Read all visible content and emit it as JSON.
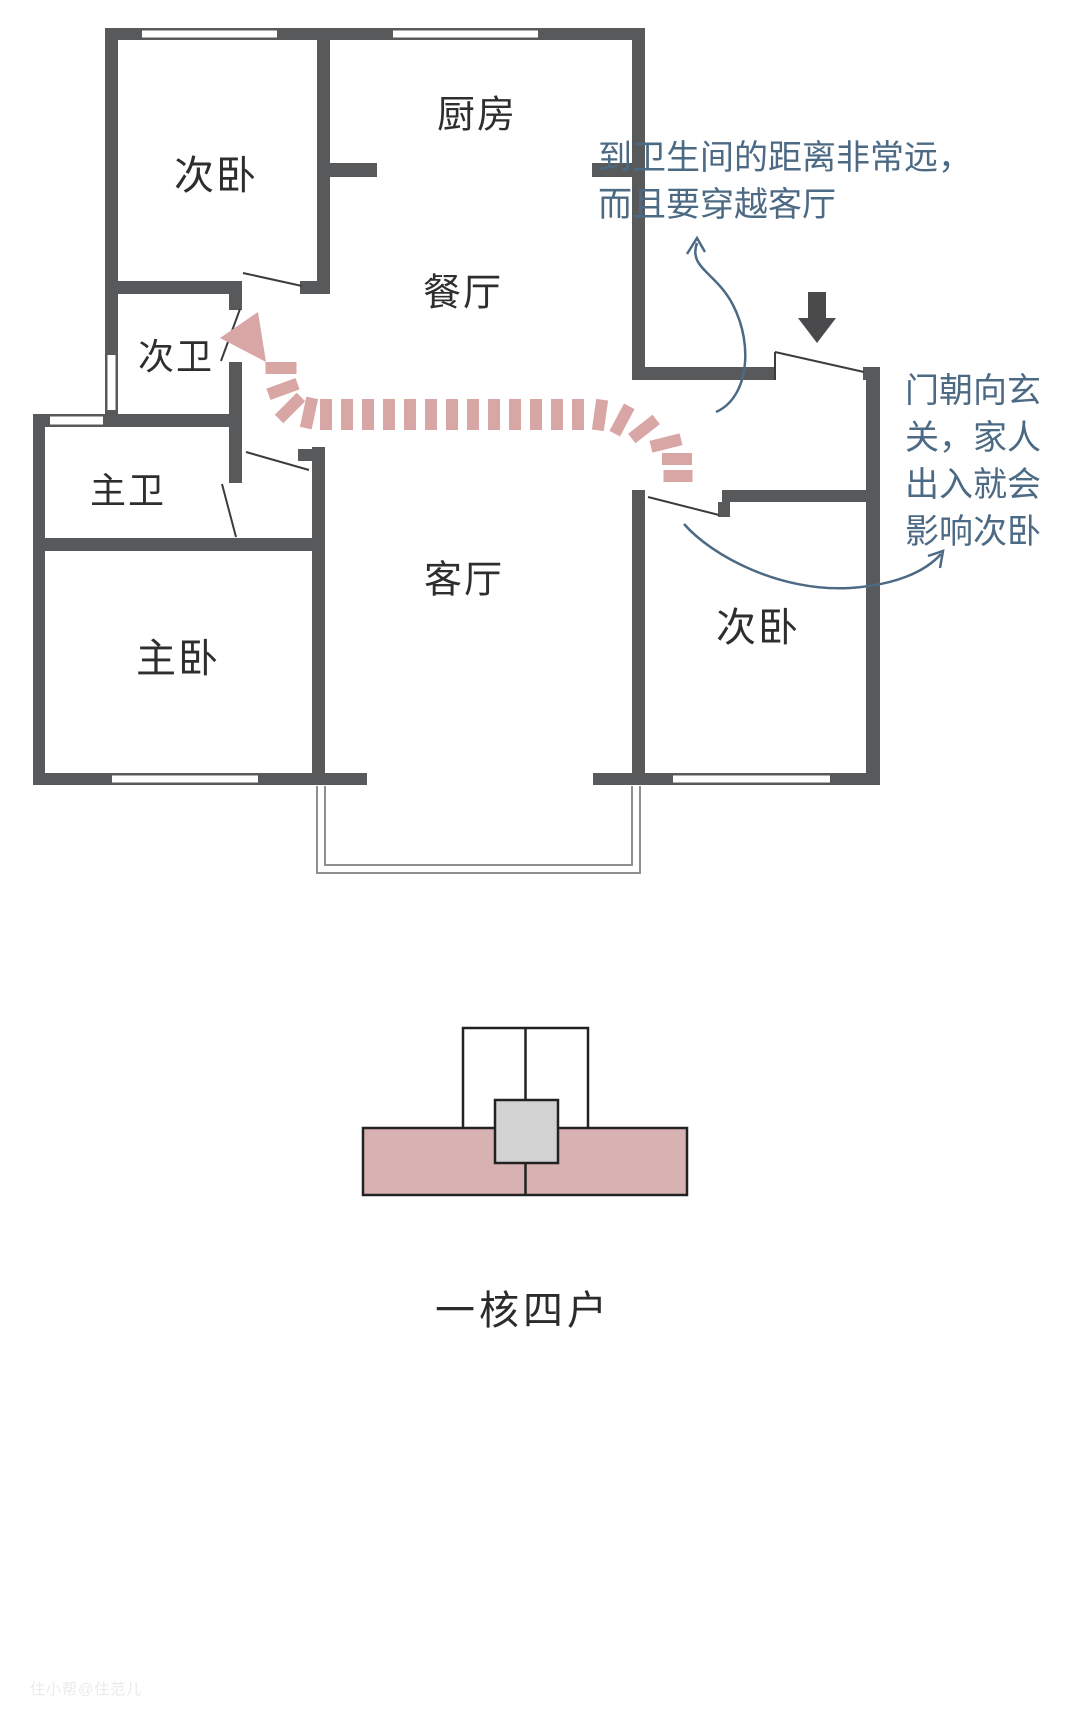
{
  "rooms": [
    {
      "id": "bedroom-top-left",
      "label": "次卧"
    },
    {
      "id": "kitchen",
      "label": "厨房"
    },
    {
      "id": "dining",
      "label": "餐厅"
    },
    {
      "id": "bath-secondary",
      "label": "次卫"
    },
    {
      "id": "bath-master",
      "label": "主卫"
    },
    {
      "id": "bedroom-master",
      "label": "主卧"
    },
    {
      "id": "living",
      "label": "客厅"
    },
    {
      "id": "bedroom-right",
      "label": "次卧"
    }
  ],
  "annotations": {
    "bathroom_distance": {
      "lines": [
        "到卫生间的距离非常远，",
        "而且要穿越客厅"
      ]
    },
    "door_facing": {
      "lines": [
        "门朝向玄",
        "关，家人",
        "出入就会",
        "影响次卧"
      ]
    }
  },
  "caption": "一核四户",
  "watermark": "住小帮@住范儿",
  "colors": {
    "wall": "#58595b",
    "path_pink": "#d9a6a6",
    "annotation_blue": "#4d6a85",
    "slab_pink": "#d8b2b2",
    "core_gray": "#d2d2d2"
  }
}
